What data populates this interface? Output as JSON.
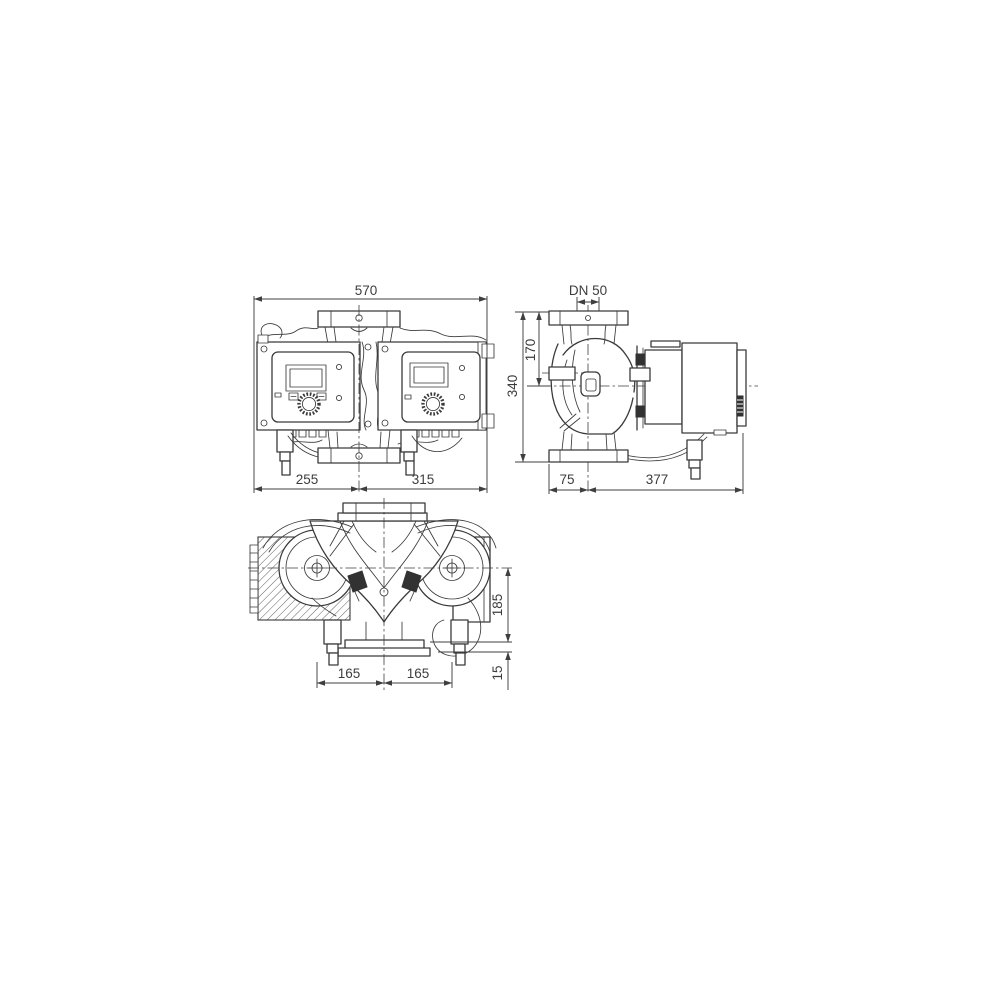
{
  "drawing": {
    "type": "technical-dimensional-drawing",
    "subject": "twin-head inline pump, three orthographic views",
    "colors": {
      "background": "#ffffff",
      "line": "#3a3a3a",
      "dimension": "#3f3f3f",
      "text": "#3d3d3d"
    },
    "views": {
      "front": {
        "dims": {
          "total_width": "570",
          "left_offset": "255",
          "right_offset": "315"
        }
      },
      "side": {
        "dims": {
          "nominal_diameter": "DN 50",
          "port_height": "170",
          "total_height": "340",
          "front_depth": "75",
          "rear_depth": "377"
        }
      },
      "top": {
        "dims": {
          "axis_offset": "185",
          "foot_offset": "15",
          "left_spacing": "165",
          "right_spacing": "165"
        }
      }
    }
  }
}
